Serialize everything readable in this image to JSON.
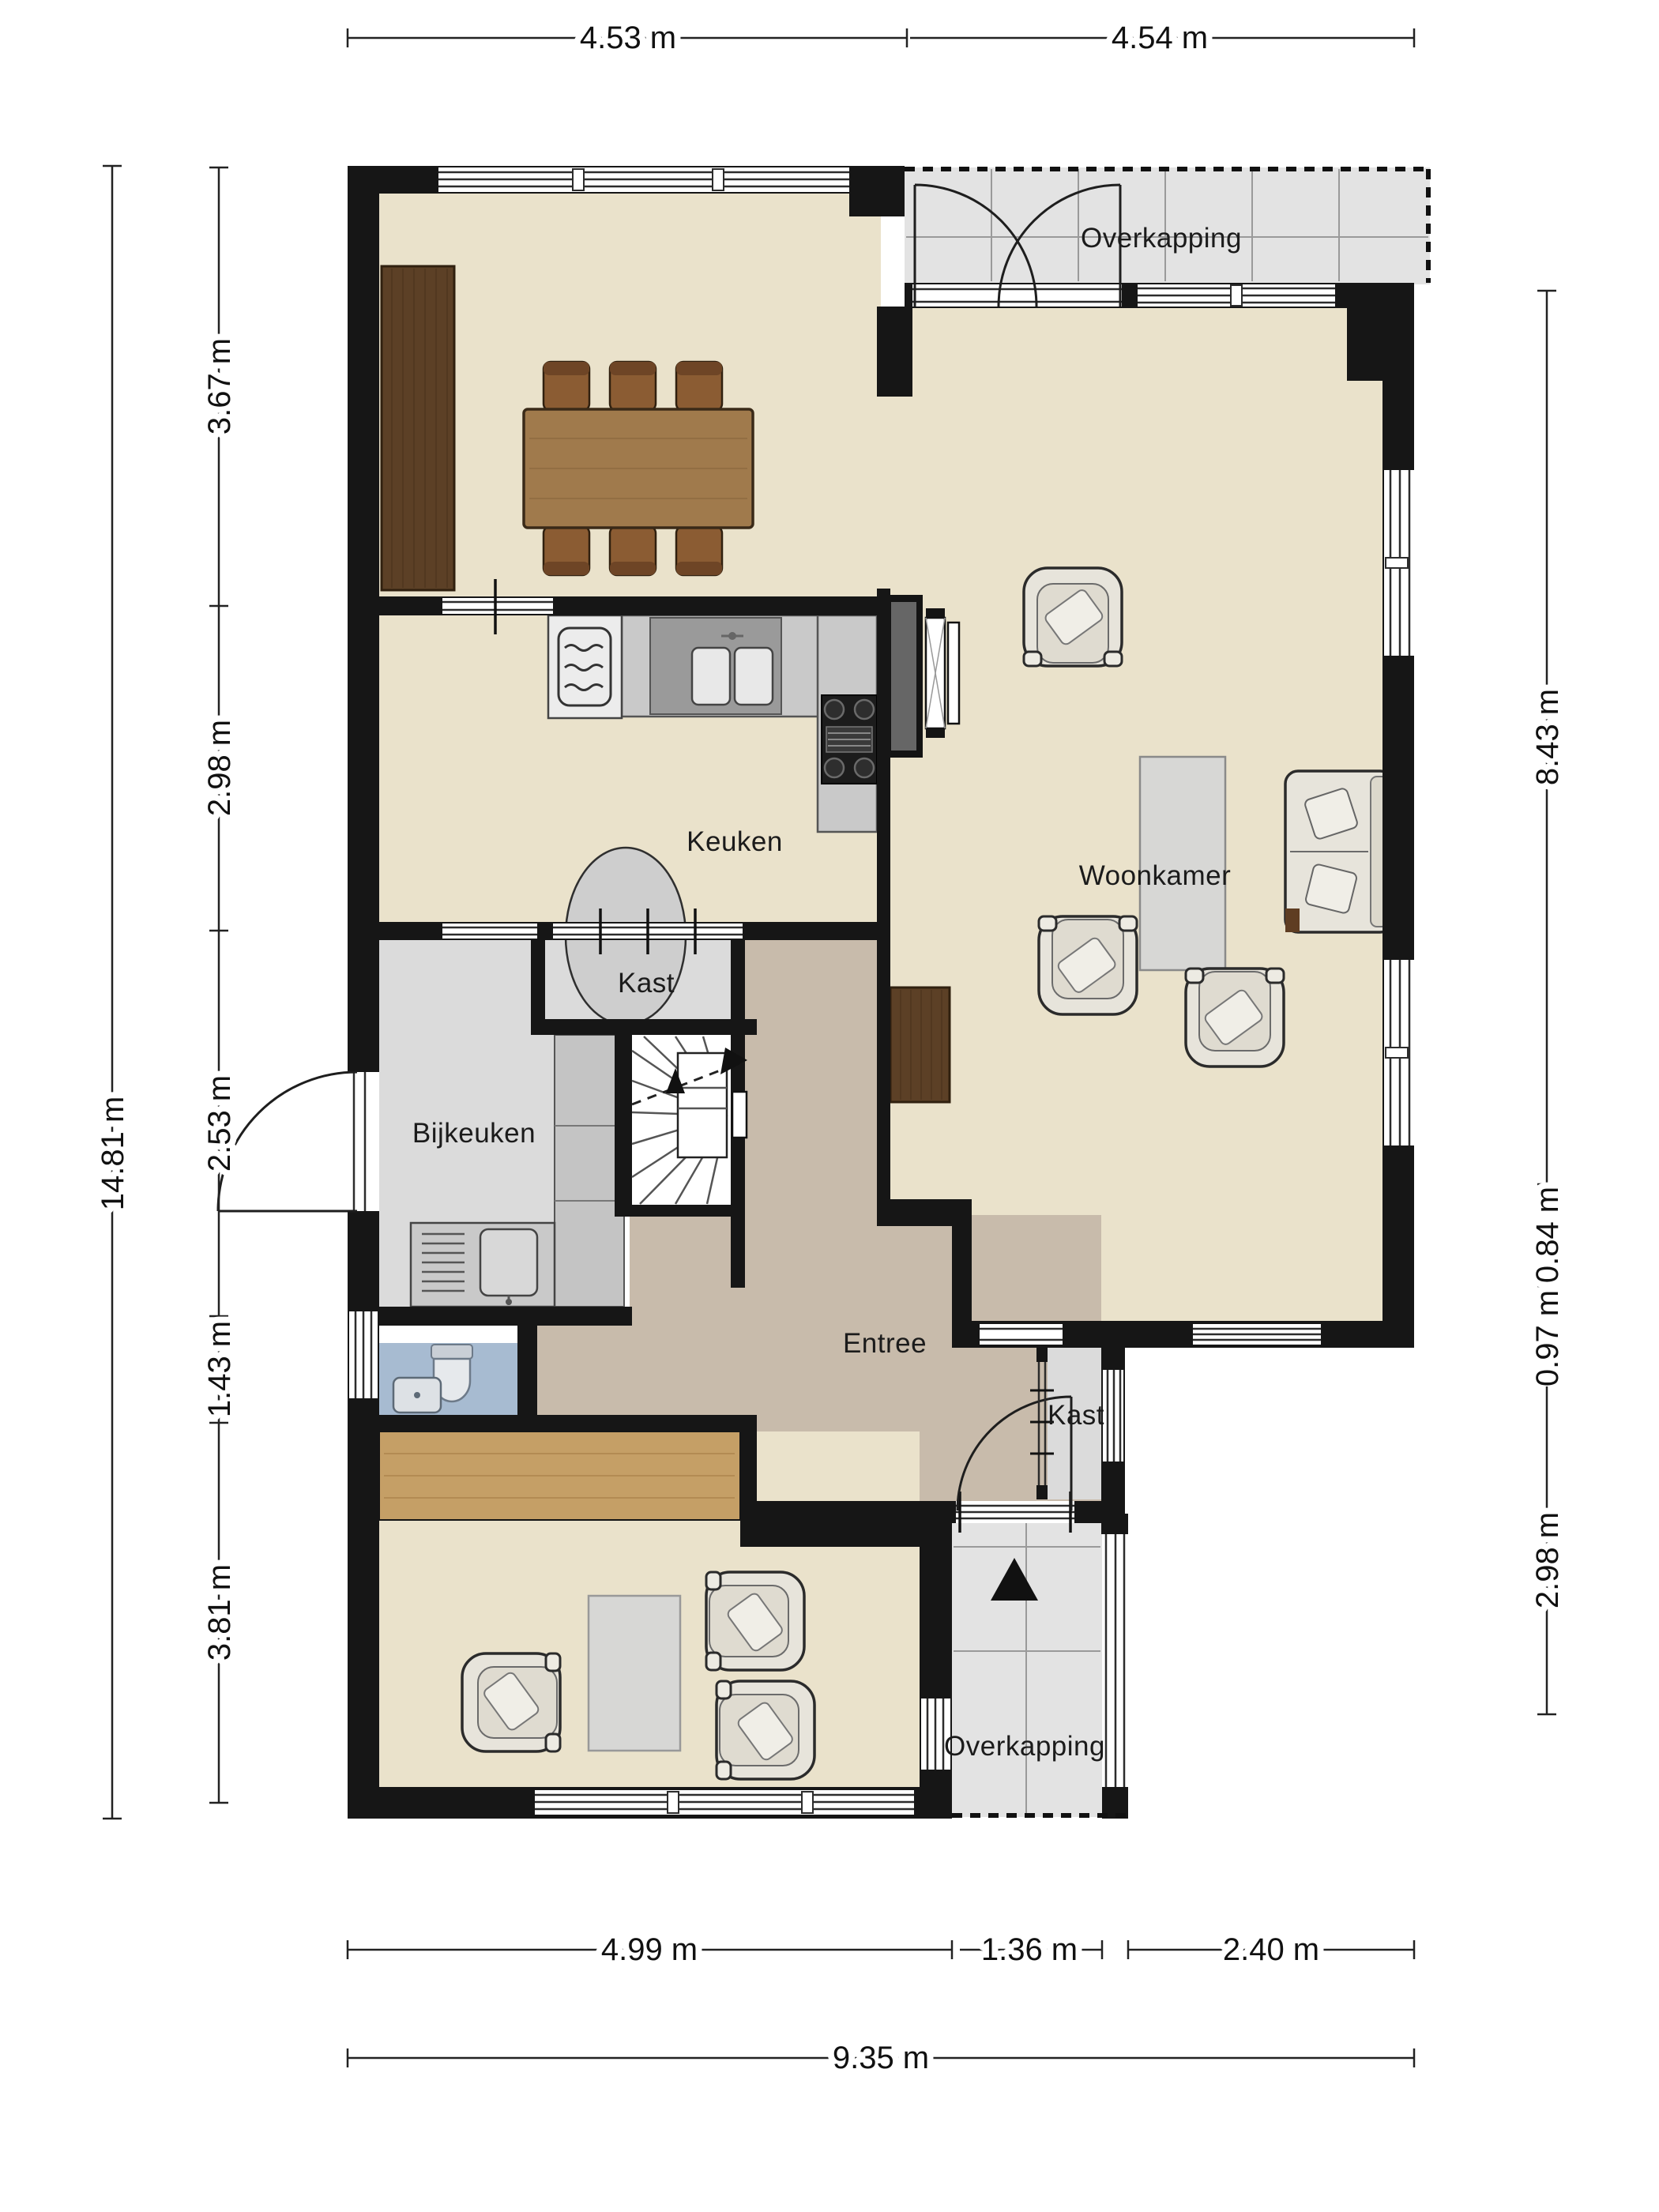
{
  "rooms": {
    "overkapping_top": "Overkapping",
    "keuken": "Keuken",
    "woonkamer": "Woonkamer",
    "kast_top": "Kast",
    "bijkeuken": "Bijkeuken",
    "kast_entree": "Kast",
    "entree": "Entree",
    "overkapping_bottom": "Overkapping"
  },
  "dimensions": {
    "top": [
      "4.53 m",
      "4.54 m"
    ],
    "left_total": "14.81 m",
    "left": [
      "3.67 m",
      "2.98 m",
      "2.53 m",
      "1.43 m",
      "3.81 m"
    ],
    "right": [
      "8.43 m",
      "0.84 m",
      "0.97 m",
      "2.98 m"
    ],
    "bottom": [
      "4.99 m",
      "1.36 m",
      "2.40 m"
    ],
    "bottom_total": "9.35 m"
  },
  "colors": {
    "wall": "#161616",
    "floor": "#EAE2CB",
    "entree": "#C8BBAB",
    "service": "#DBDBDB",
    "toilet": "#A7BBD1",
    "terrace": "#E3E3E3",
    "wood_dark": "#5C4026",
    "wood_table": "#A07A4C",
    "wood_chair": "#8B5C33",
    "wood_band": "#C59F66",
    "counter": "#C9C9C9",
    "counter_dark": "#9A9A9A",
    "fabric": "#E7E4DB",
    "fabric_seat": "#DFDBD0",
    "rug": "#CECECE",
    "tabletop": "#D7D7D5"
  }
}
